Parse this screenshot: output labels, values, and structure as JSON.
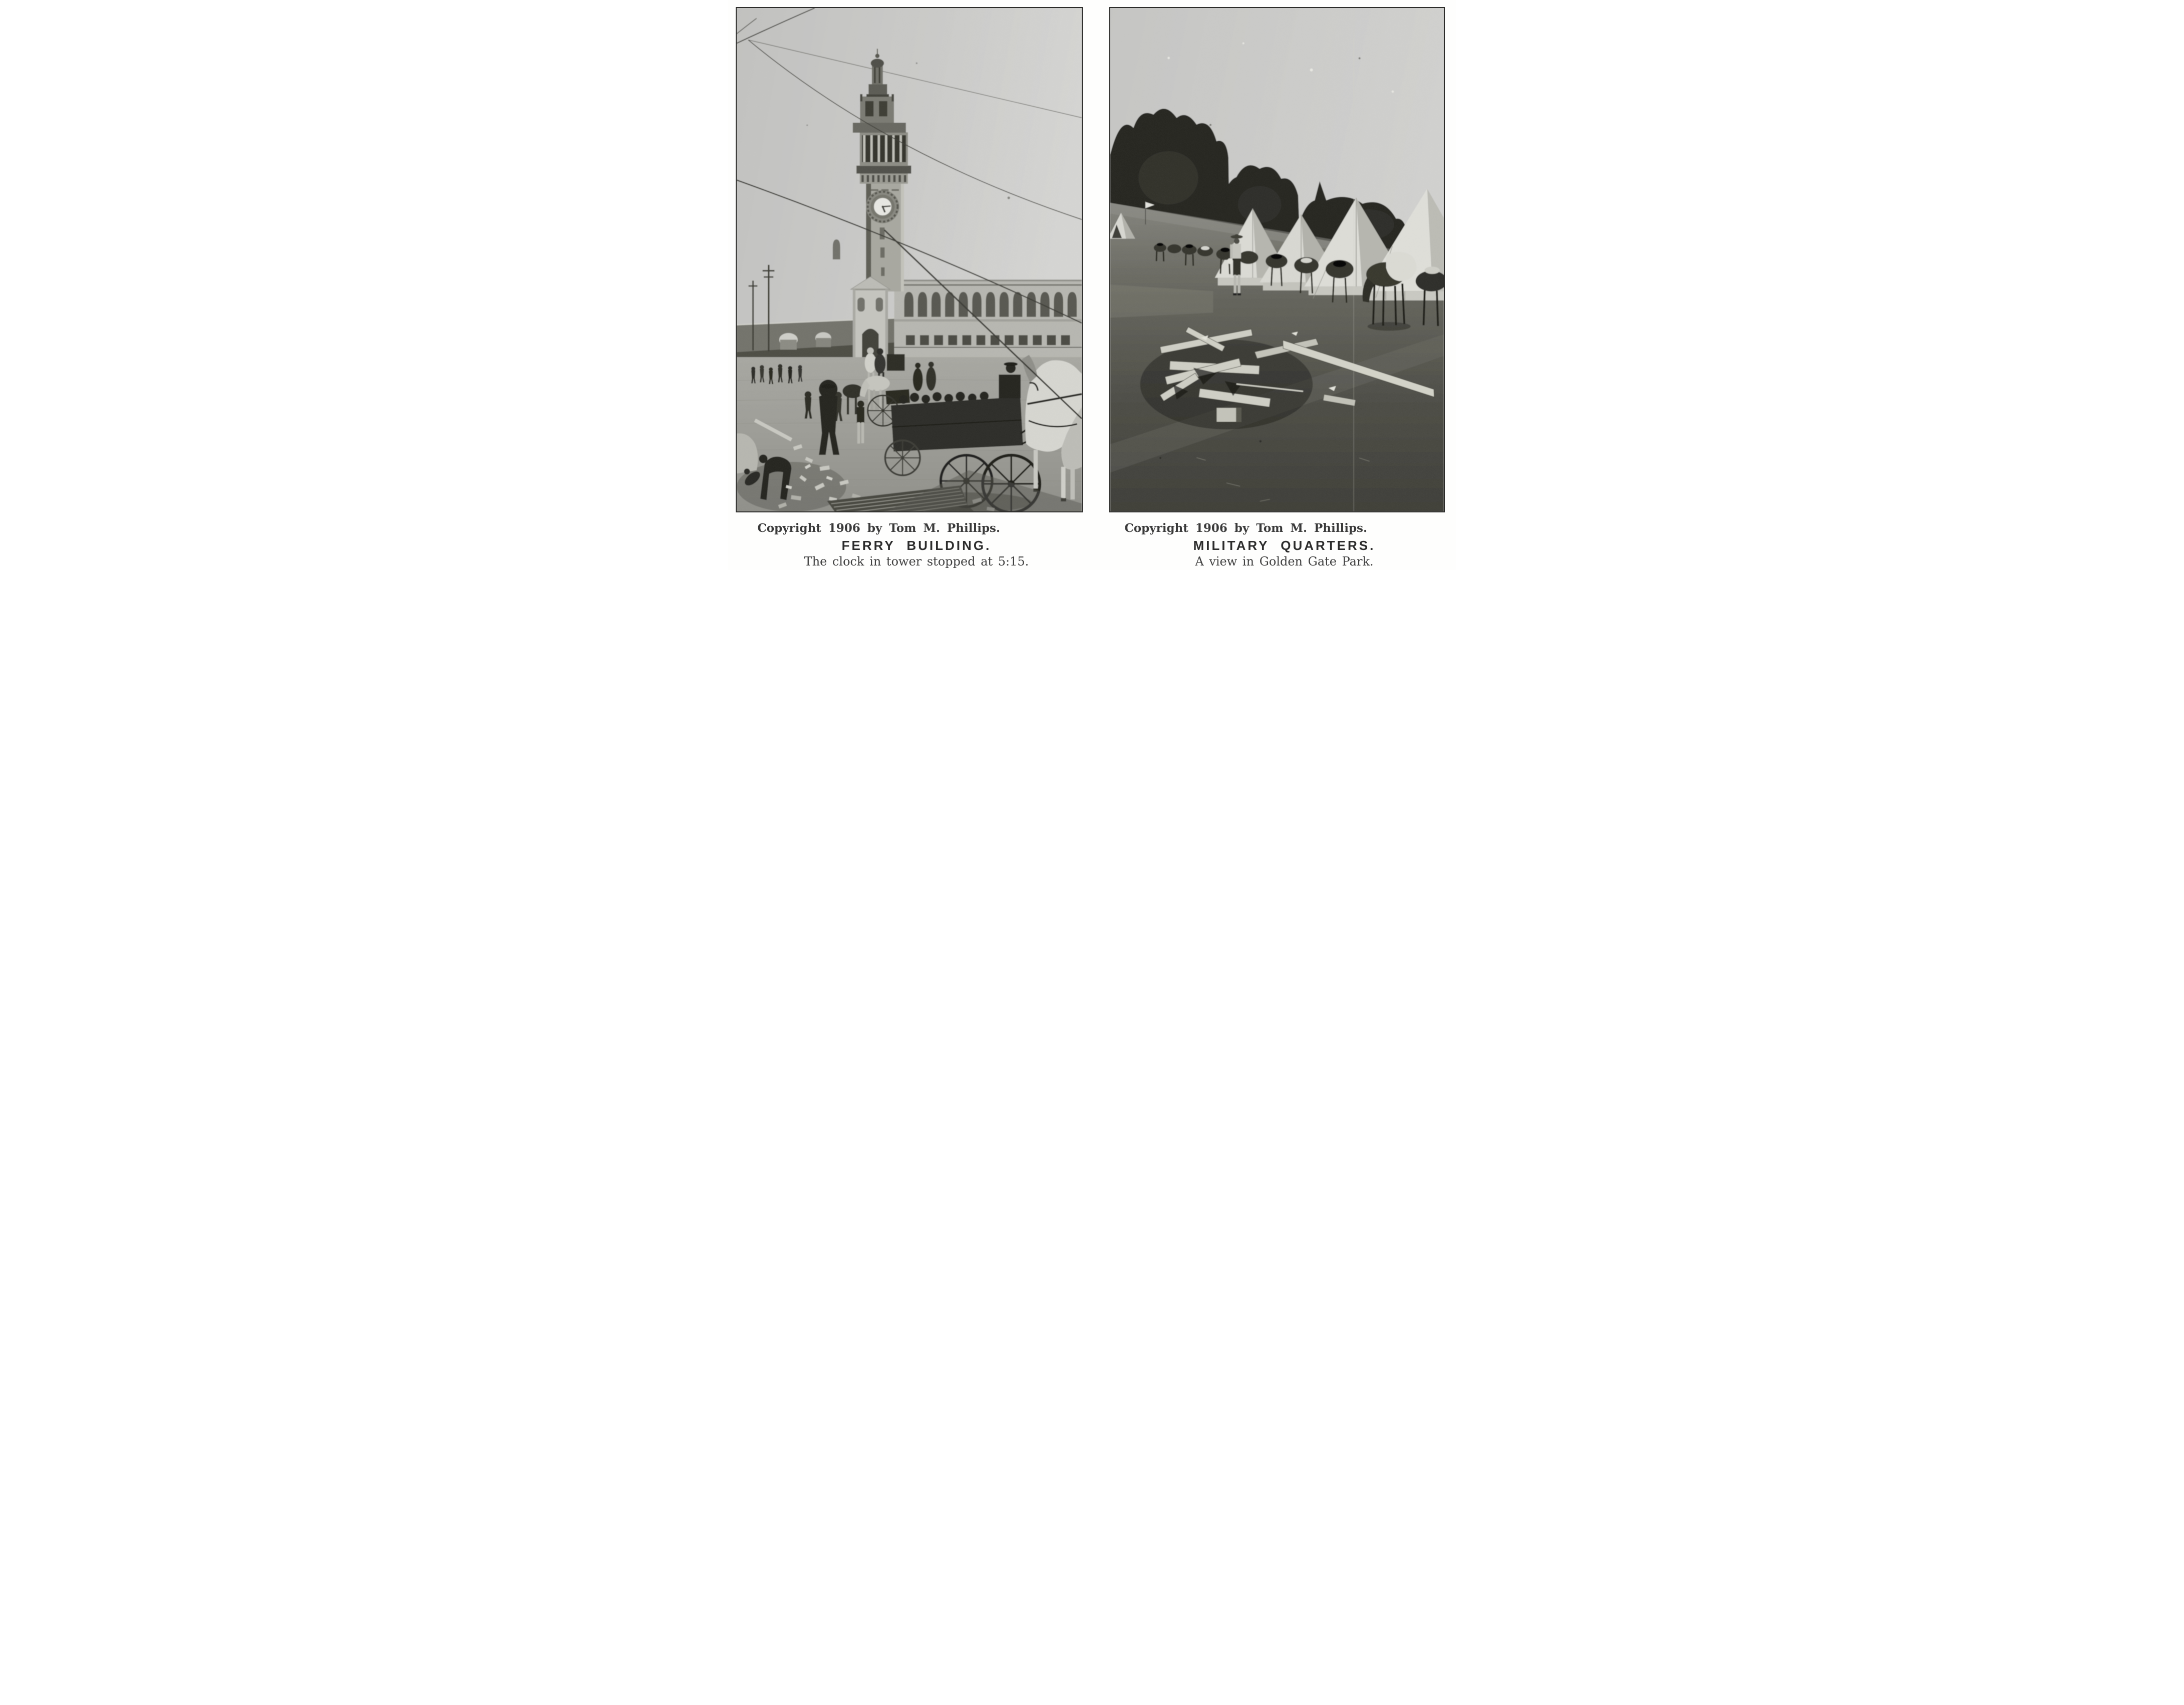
{
  "page": {
    "kind": "scanned book plate page, two halftone photographs with letterpress captions",
    "paper_color": "#fefefd",
    "photo_tone": "grayscale halftone"
  },
  "plates": [
    {
      "side": "left",
      "photo_description": "Halftone photograph: the Ferry Building clock tower rises above a long arcaded facade; telegraph wires cross a pale sky; the street below is crowded with pedestrians, horse-drawn wagons and a white dray horse; earthquake rubble, loose bricks and a sheet of corrugated iron litter the pavement",
      "clock_time_shown": "5:15",
      "copyright": "Copyright 1906 by Tom M. Phillips.",
      "title": "FERRY BUILDING.",
      "subtitle": "The clock in tower stopped at 5:15."
    },
    {
      "side": "right",
      "photo_description": "Halftone photograph: an army encampment in Golden Gate Park with a row of tall conical bell tents beneath dark trees, a picket line of saddled horses and mules, a uniformed soldier standing in camp, and a pile of lumber strewn on trampled grass",
      "copyright": "Copyright 1906 by Tom M. Phillips.",
      "title": "MILITARY QUARTERS.",
      "subtitle": "A view in Golden Gate Park."
    }
  ]
}
